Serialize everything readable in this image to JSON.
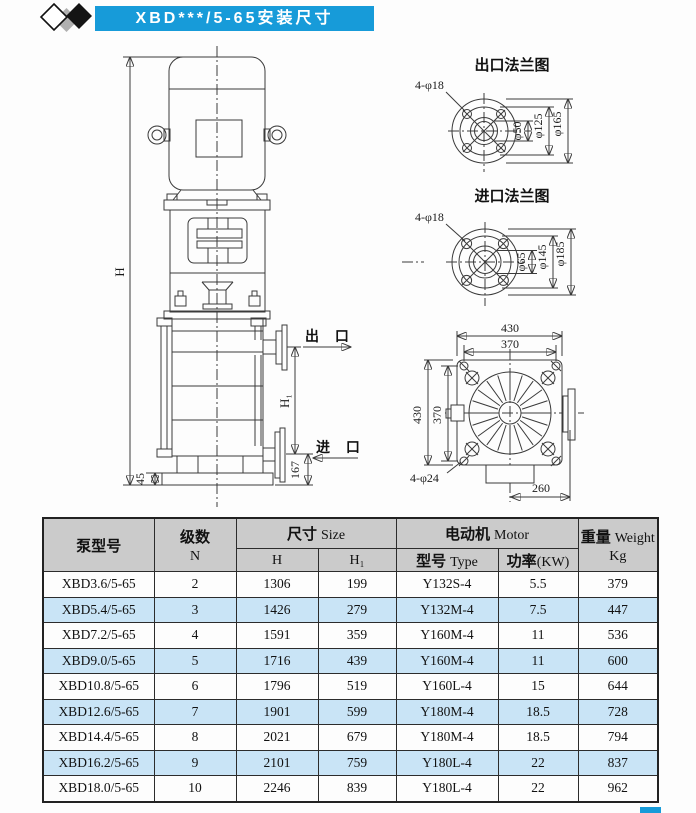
{
  "title_bar": {
    "text": "XBD***/5-65安装尺寸"
  },
  "colors": {
    "accent": "#179bd9",
    "row_alt": "#c9e4f6",
    "header_bg": "#cbcbcb",
    "line": "#3a3a3a"
  },
  "pump_view": {
    "h_label": "H",
    "h1_label": "H₁",
    "dim_45": "45",
    "dim_167": "167",
    "outlet_label": "出 口",
    "inlet_label": "进 口"
  },
  "outlet_flange": {
    "title": "出口法兰图",
    "bolt_label": "4-φ18",
    "d_inner": "φ50",
    "d_bolt_circle": "φ125",
    "d_outer": "φ165"
  },
  "inlet_flange": {
    "title": "进口法兰图",
    "bolt_label": "4-φ18",
    "d_inner": "φ65",
    "d_bolt_circle": "φ145",
    "d_outer": "φ185"
  },
  "base_view": {
    "dim_top_outer": "430",
    "dim_top_inner": "370",
    "dim_left_outer": "430",
    "dim_left_inner": "370",
    "bolt_label": "4-φ24",
    "dim_bottom": "260"
  },
  "table": {
    "headers": {
      "model": "泵型号",
      "stages_zh": "级数",
      "stages_en": "N",
      "size_zh": "尺寸",
      "size_en": "Size",
      "h": "H",
      "h1": "H₁",
      "motor_zh": "电动机",
      "motor_en": "Motor",
      "type_zh": "型号",
      "type_en": "Type",
      "power_zh": "功率",
      "power_en": "(KW)",
      "weight_zh": "重量",
      "weight_en": "Weight",
      "weight_unit": "Kg"
    },
    "rows": [
      [
        "XBD3.6/5-65",
        "2",
        "1306",
        "199",
        "Y132S-4",
        "5.5",
        "379"
      ],
      [
        "XBD5.4/5-65",
        "3",
        "1426",
        "279",
        "Y132M-4",
        "7.5",
        "447"
      ],
      [
        "XBD7.2/5-65",
        "4",
        "1591",
        "359",
        "Y160M-4",
        "11",
        "536"
      ],
      [
        "XBD9.0/5-65",
        "5",
        "1716",
        "439",
        "Y160M-4",
        "11",
        "600"
      ],
      [
        "XBD10.8/5-65",
        "6",
        "1796",
        "519",
        "Y160L-4",
        "15",
        "644"
      ],
      [
        "XBD12.6/5-65",
        "7",
        "1901",
        "599",
        "Y180M-4",
        "18.5",
        "728"
      ],
      [
        "XBD14.4/5-65",
        "8",
        "2021",
        "679",
        "Y180M-4",
        "18.5",
        "794"
      ],
      [
        "XBD16.2/5-65",
        "9",
        "2101",
        "759",
        "Y180L-4",
        "22",
        "837"
      ],
      [
        "XBD18.0/5-65",
        "10",
        "2246",
        "839",
        "Y180L-4",
        "22",
        "962"
      ]
    ]
  }
}
